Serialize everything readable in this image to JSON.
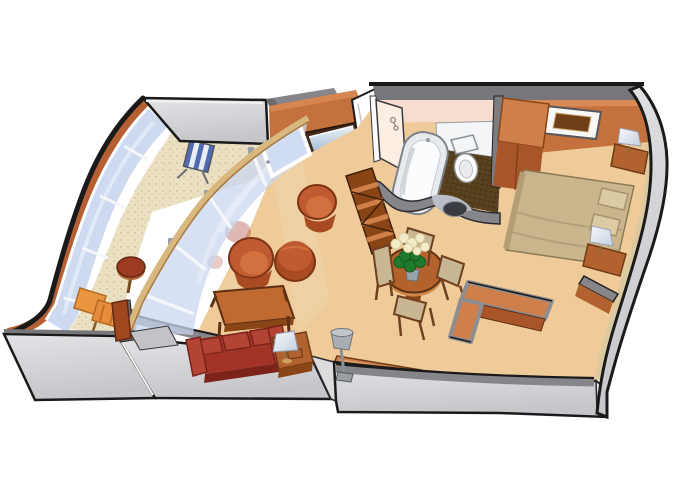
{
  "illustration": {
    "type": "cruise-ship-suite-cutaway-floor-plan",
    "view": "isometric cutaway, no text labels",
    "rooms": [
      {
        "name": "veranda",
        "furniture": [
          "curved glass balustrade",
          "striped deck chair",
          "round side table",
          "chaise lounge chair"
        ]
      },
      {
        "name": "living-room",
        "furniture": [
          "glass partition wall with sliding door",
          "tv above dresser",
          "tub chair",
          "armchair",
          "ottoman",
          "coffee table",
          "three-seat sofa",
          "side table with table lamp",
          "floor lamp",
          "credenza",
          "zigzag etagere shelf"
        ]
      },
      {
        "name": "dining-area",
        "furniture": [
          "oval dining table",
          "dining chair x4",
          "vase with white flowers"
        ]
      },
      {
        "name": "bathroom",
        "furniture": [
          "bathtub",
          "toilet",
          "white counter",
          "dark tile floor",
          "curved vanity wall with basin"
        ]
      },
      {
        "name": "bedroom",
        "furniture": [
          "double bed with pillows",
          "nightstand with lamp x2",
          "framed wall picture",
          "wardrobe closet",
          "l-shaped cabinet",
          "wall stub"
        ]
      },
      {
        "name": "entry",
        "furniture": [
          "open entry door"
        ]
      }
    ]
  },
  "colors": {
    "outline": "#1a1a1a",
    "floor_tan": "#eecb99",
    "balcony_floor": "#ece0c2",
    "wall_terracotta": "#c4713d",
    "wall_terracotta_dark": "#a9552a",
    "wall_terracotta_light": "#d98a55",
    "wood_mid": "#b2622e",
    "wood_dark": "#6f3a16",
    "wood_light": "#cf7f49",
    "wall_gray": "#85858a",
    "wall_gray_dark": "#6a6a6f",
    "slab_gray": "#c6c6ca",
    "slab_gray_light": "#e4e4e7",
    "glass_blue": "#c9d7ef",
    "hull_band": "#b55f33",
    "sofa_red": "#a33326",
    "sofa_cushion": "#b24335",
    "chair_rust": "#bf5a31",
    "chair_rust_light": "#d1713f",
    "chair_rust_dark": "#a94b22",
    "lounger_orange": "#ea9540",
    "deckchair_blue": "#4f6cb0",
    "bathroom_pink": "#f7ddd0",
    "bathroom_pink_light": "#fdeee4",
    "fixture_white": "#f4f5f7",
    "tile_brown": "#5b431f",
    "basin_dark": "#3b3b42",
    "bed_tan": "#cbb58d",
    "pillow_tan": "#dccaa4",
    "chair_seat_tan": "#c9b692",
    "lamp_white": "#eef2f8",
    "lamp_gray": "#a9adb4",
    "leaf_green": "#1f7a2d",
    "flower_cream": "#f3ecc9"
  }
}
